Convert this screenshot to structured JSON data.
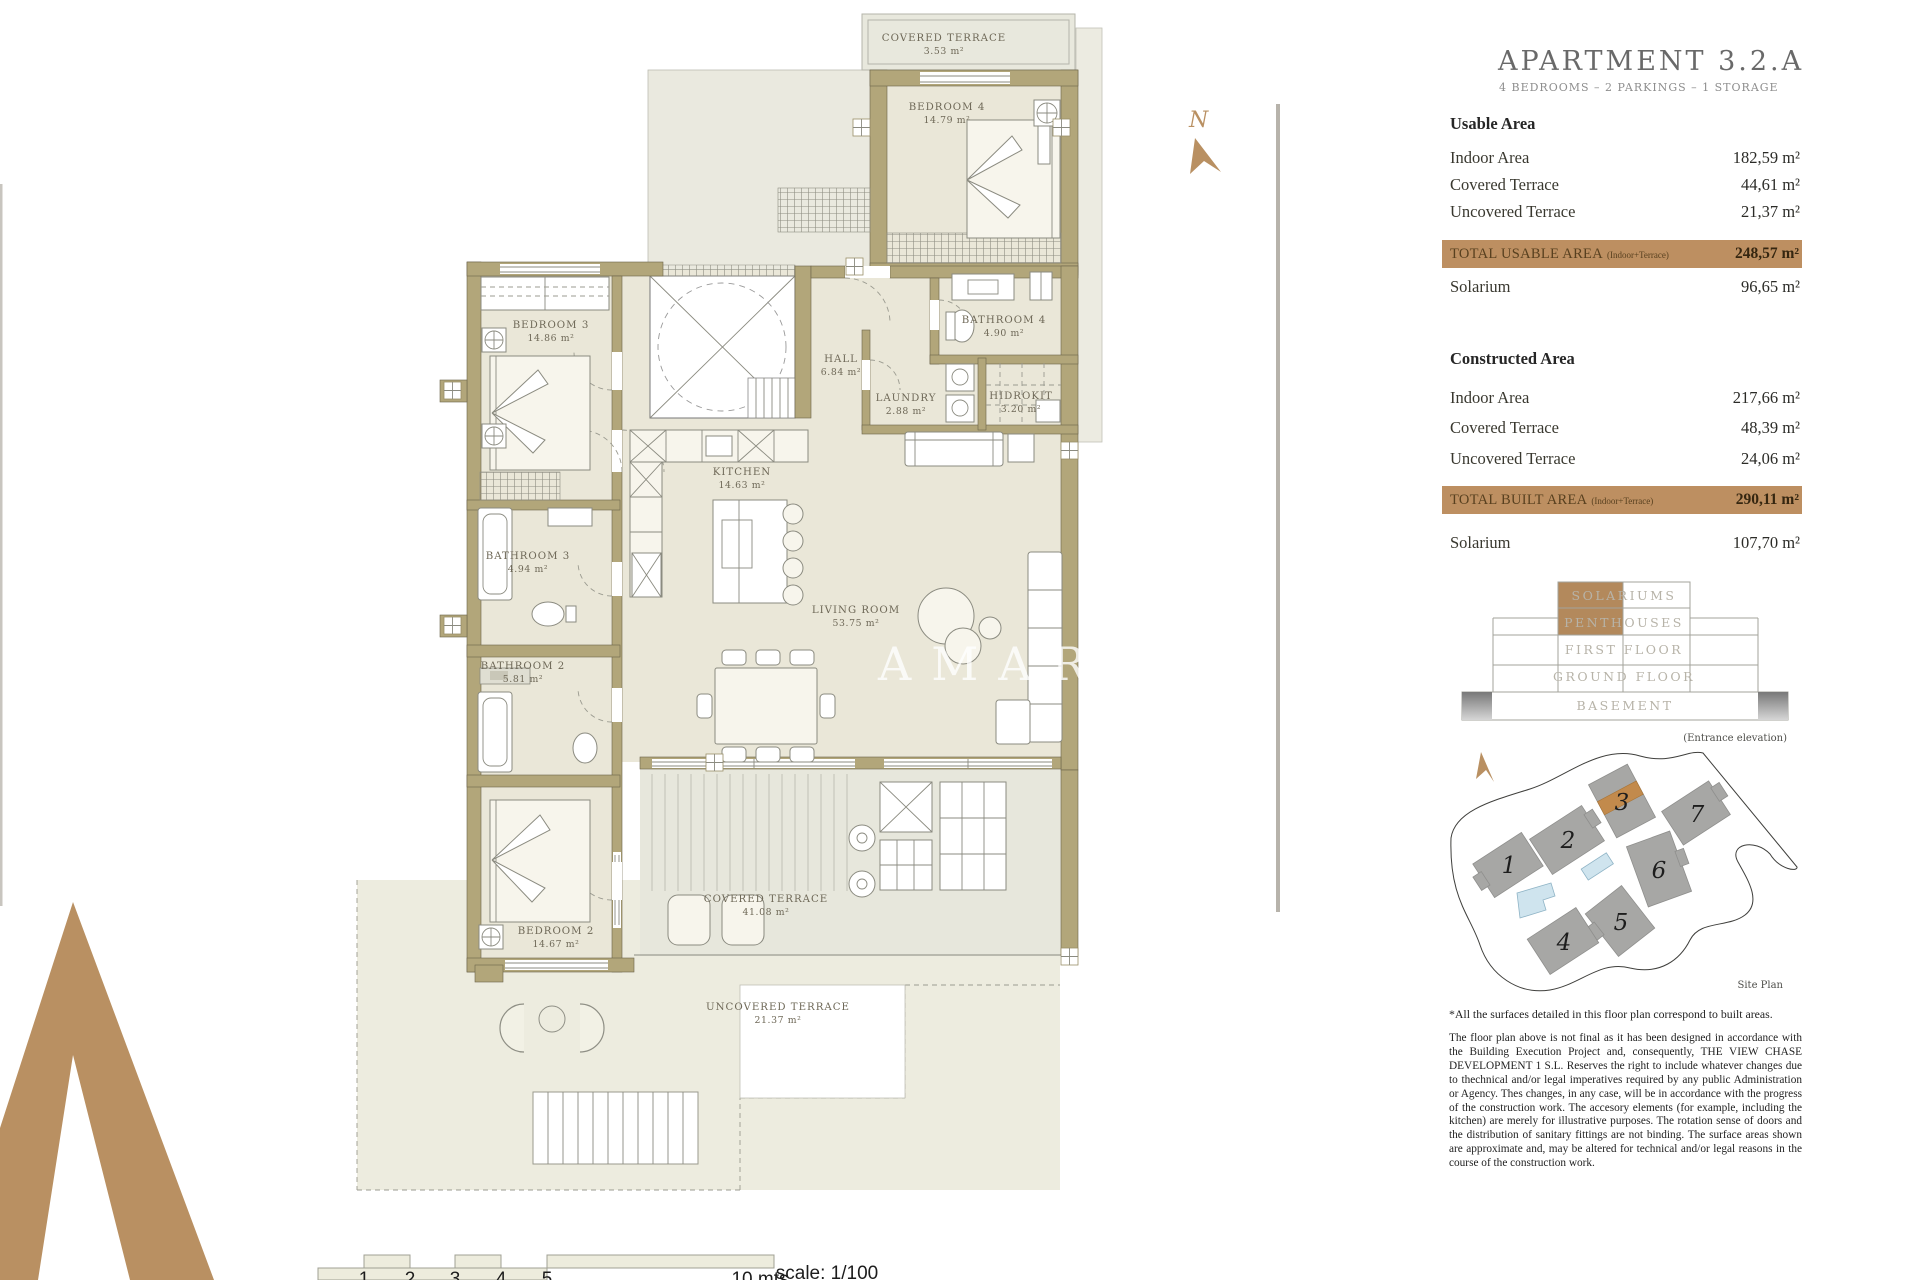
{
  "header": {
    "title": "APARTMENT 3.2.A",
    "subtitle": "4 BEDROOMS – 2 PARKINGS – 1 STORAGE"
  },
  "brand": {
    "watermark": "AMARU",
    "north_label": "N"
  },
  "usable": {
    "heading": "Usable Area",
    "rows": [
      {
        "label": "Indoor Area",
        "value": "182,59 m²"
      },
      {
        "label": "Covered Terrace",
        "value": "44,61 m²"
      },
      {
        "label": "Uncovered Terrace",
        "value": "21,37 m²"
      }
    ],
    "total_label": "TOTAL USABLE AREA",
    "total_note": "(Indoor+Terrace)",
    "total_value": "248,57 m²",
    "solarium_label": "Solarium",
    "solarium_value": "96,65 m²"
  },
  "constructed": {
    "heading": "Constructed Area",
    "rows": [
      {
        "label": "Indoor Area",
        "value": "217,66 m²"
      },
      {
        "label": "Covered Terrace",
        "value": "48,39 m²"
      },
      {
        "label": "Uncovered Terrace",
        "value": "24,06 m²"
      }
    ],
    "total_label": "TOTAL BUILT AREA",
    "total_note": "(Indoor+Terrace)",
    "total_value": "290,11 m²",
    "solarium_label": "Solarium",
    "solarium_value": "107,70 m²"
  },
  "elevation": {
    "floors": [
      "SOLARIUMS",
      "PENTHOUSES",
      "FIRST FLOOR",
      "GROUND FLOOR",
      "BASEMENT"
    ],
    "caption": "(Entrance elevation)"
  },
  "site_plan": {
    "caption": "Site Plan",
    "buildings": [
      "1",
      "2",
      "3",
      "4",
      "5",
      "6",
      "7"
    ],
    "highlighted_building": "3"
  },
  "rooms": [
    {
      "name": "COVERED TERRACE",
      "area": "3.53 m²"
    },
    {
      "name": "BEDROOM 4",
      "area": "14.79 m²"
    },
    {
      "name": "BEDROOM 3",
      "area": "14.86 m²"
    },
    {
      "name": "BATHROOM 4",
      "area": "4.90 m²"
    },
    {
      "name": "HALL",
      "area": "6.84 m²"
    },
    {
      "name": "LAUNDRY",
      "area": "2.88 m²"
    },
    {
      "name": "HIDROKIT",
      "area": "3.20 m²"
    },
    {
      "name": "KITCHEN",
      "area": "14.63 m²"
    },
    {
      "name": "BATHROOM 3",
      "area": "4.94 m²"
    },
    {
      "name": "LIVING ROOM",
      "area": "53.75 m²"
    },
    {
      "name": "BATHROOM 2",
      "area": "5.81 m²"
    },
    {
      "name": "BEDROOM 2",
      "area": "14.67 m²"
    },
    {
      "name": "COVERED TERRACE",
      "area": "41.08 m²"
    },
    {
      "name": "UNCOVERED TERRACE",
      "area": "21.37 m²"
    }
  ],
  "notes": {
    "footnote": "*All the surfaces detailed in this floor plan correspond to built areas.",
    "disclaimer": "The floor plan above is not final as it has been designed in accordance with the Building Execution Project and, consequently, THE VIEW CHASE DEVELOPMENT 1 S.L. Reserves the right to include whatever changes due to thechnical and/or legal imperatives required by any public Administration or Agency. Thes changes, in any case, will be in accordance with the progress of the construction work. The accesory elements (for example, including the kitchen) are merely for illustrative purposes. The rotation sense of doors and the distribution of sanitary fittings are not binding. The surface areas shown are approximate and, may be altered for technical and/or legal reasons in the course of the construction work."
  },
  "scale_bar": {
    "ticks": [
      "1",
      "2",
      "3",
      "4",
      "5"
    ],
    "end_label": "10 mts",
    "scale_label": "scale: 1/100"
  },
  "colors": {
    "accent_tan": "#bd8f61",
    "wall_tan": "#b2a67a",
    "indoor_fill": "#eae7d8",
    "terrace_fill": "#e7e7dc",
    "building_gray": "#a7a7a5",
    "pool_blue": "#cfe4ee"
  }
}
